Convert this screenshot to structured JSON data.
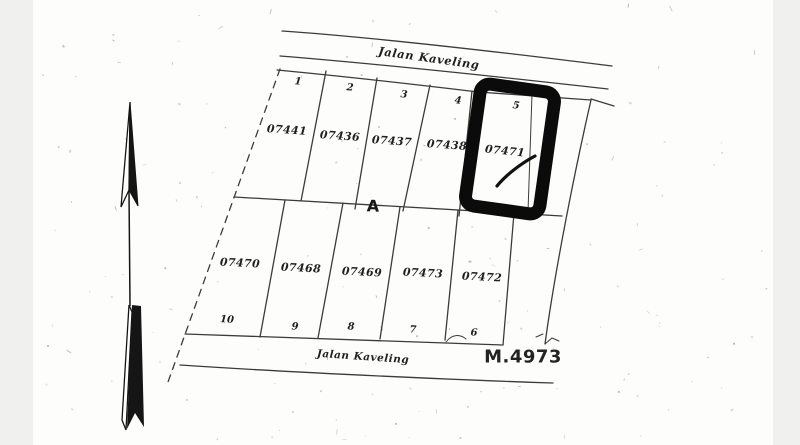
{
  "page": {
    "paper_color": "#fdfdfc",
    "margin_color": "#f0f0ee",
    "ink_color": "#2a2a2a",
    "highlight_color": "#0b0b0b"
  },
  "map": {
    "road_top_label": "Jalan Kaveling",
    "road_bottom_label": "Jalan Kaveling",
    "block_label": "A",
    "sheet_number": "M.4973",
    "north_arrow": "north-arrow-symbol",
    "top_row": [
      {
        "index": "1",
        "cert": "07441",
        "highlighted": false
      },
      {
        "index": "2",
        "cert": "07436",
        "highlighted": false
      },
      {
        "index": "3",
        "cert": "07437",
        "highlighted": false
      },
      {
        "index": "4",
        "cert": "07438",
        "highlighted": false
      },
      {
        "index": "5",
        "cert": "07471",
        "highlighted": true
      }
    ],
    "bottom_row": [
      {
        "index": "10",
        "cert": "07470",
        "highlighted": false
      },
      {
        "index": "9",
        "cert": "07468",
        "highlighted": false
      },
      {
        "index": "8",
        "cert": "07469",
        "highlighted": false
      },
      {
        "index": "7",
        "cert": "07473",
        "highlighted": false
      },
      {
        "index": "6",
        "cert": "07472",
        "highlighted": false
      }
    ]
  }
}
